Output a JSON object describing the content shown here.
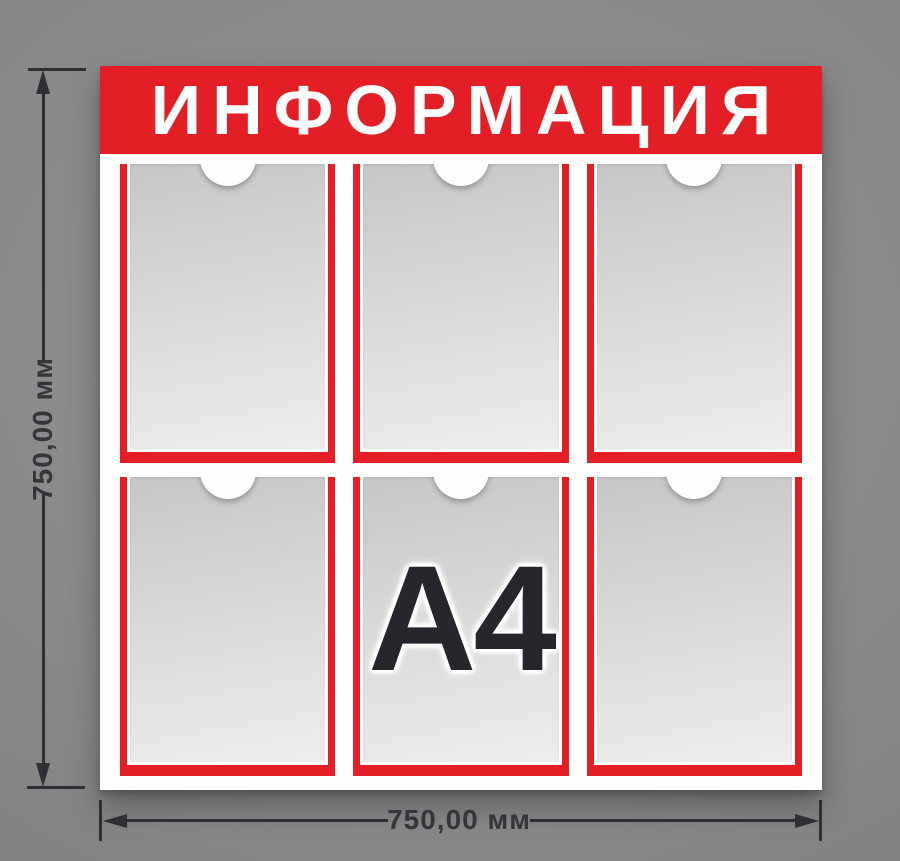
{
  "board": {
    "title": "ИНФОРМАЦИЯ",
    "pockets": [
      {
        "label": ""
      },
      {
        "label": ""
      },
      {
        "label": ""
      },
      {
        "label": ""
      },
      {
        "label": "A4"
      },
      {
        "label": ""
      }
    ]
  },
  "dimensions": {
    "height_label": "750,00 мм",
    "width_label": "750,00 мм"
  },
  "colors": {
    "accent_red": "#e31e24",
    "board_white": "#fdfdfd",
    "pocket_gray_dark": "#c6c6c8",
    "pocket_gray_light": "#ededee",
    "dimension_ink": "#2f2f36",
    "background_gray": "#888888",
    "a4_text": "#26262d",
    "title_text": "#ffffff"
  }
}
